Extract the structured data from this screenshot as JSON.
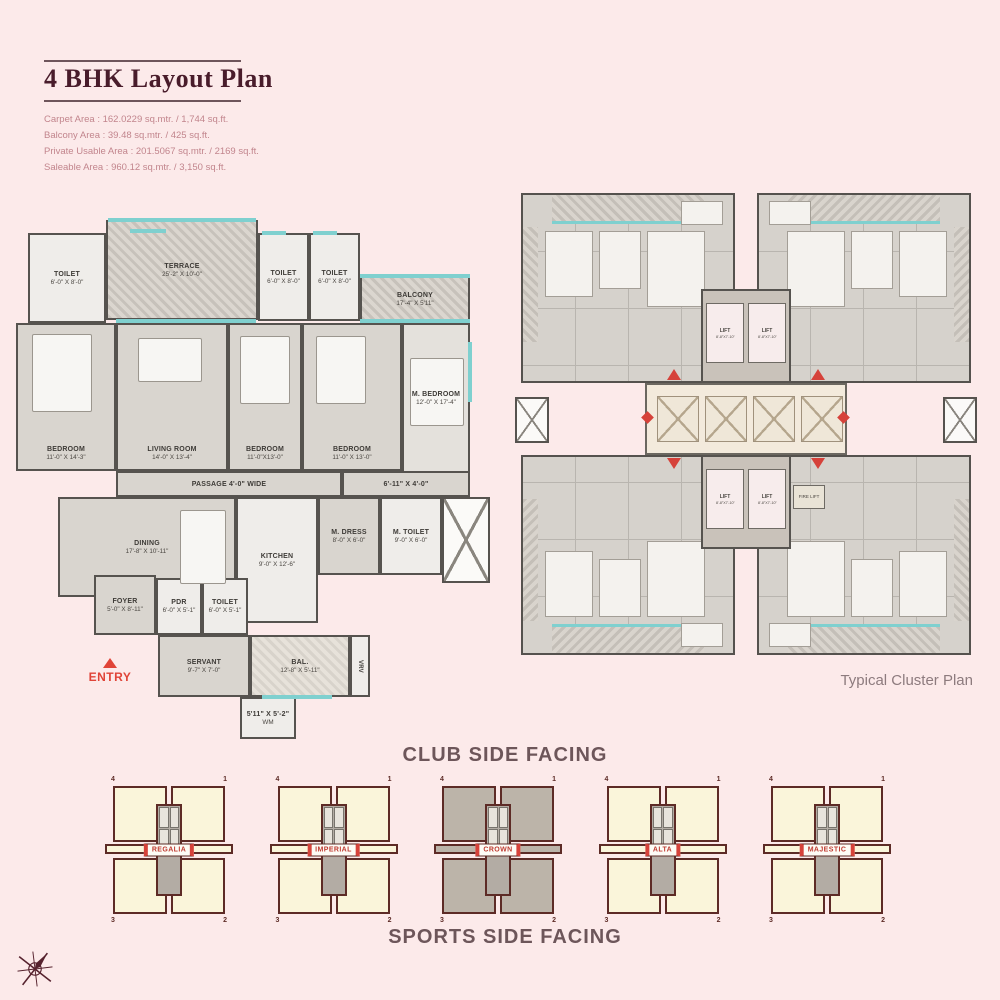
{
  "colors": {
    "background": "#fceaea",
    "accent_red": "#d6423a",
    "maroon": "#491c2b",
    "cream": "#faf5da",
    "teal": "#7fd0cf"
  },
  "header": {
    "title": "4 BHK Layout Plan",
    "area_lines": [
      "Carpet Area : 162.0229 sq.mtr. / 1,744 sq.ft.",
      "Balcony Area : 39.48 sq.mtr. / 425 sq.ft.",
      "Private Usable Area : 201.5067 sq.mtr. / 2169 sq.ft.",
      "Saleable Area : 960.12 sq.mtr. / 3,150 sq.ft."
    ]
  },
  "unit_plan": {
    "entry_label": "ENTRY",
    "rooms": [
      {
        "id": "toilet1",
        "name": "TOILET",
        "dim": "6'-0\" X 8'-0\""
      },
      {
        "id": "terrace",
        "name": "TERRACE",
        "dim": "25'-2\" X 10'-0\""
      },
      {
        "id": "toilet2",
        "name": "TOILET",
        "dim": "6'-0\" X 8'-0\""
      },
      {
        "id": "toilet3",
        "name": "TOILET",
        "dim": "6'-0\" X 8'-0\""
      },
      {
        "id": "balcony",
        "name": "BALCONY",
        "dim": "17'-4\" X 5'11\""
      },
      {
        "id": "bedroom1",
        "name": "BEDROOM",
        "dim": "11'-0\" X 14'-3\""
      },
      {
        "id": "living",
        "name": "LIVING ROOM",
        "dim": "14'-0\" X 13'-4\""
      },
      {
        "id": "bedroom2",
        "name": "BEDROOM",
        "dim": "11'-0\"X13'-0\""
      },
      {
        "id": "bedroom3",
        "name": "BEDROOM",
        "dim": "11'-0\" X 13'-0\""
      },
      {
        "id": "mbedroom",
        "name": "M. BEDROOM",
        "dim": "12'-0\" X 17'-4\""
      },
      {
        "id": "passage",
        "name": "PASSAGE 4'-0\" WIDE",
        "dim": ""
      },
      {
        "id": "passage2",
        "name": "6'-11\" X 4'-0\"",
        "dim": ""
      },
      {
        "id": "dining",
        "name": "DINING",
        "dim": "17'-8\" X 10'-11\""
      },
      {
        "id": "kitchen",
        "name": "KITCHEN",
        "dim": "9'-0\" X 12'-6\""
      },
      {
        "id": "mdress",
        "name": "M. DRESS",
        "dim": "8'-0\" X 6'-0\""
      },
      {
        "id": "mtoilet",
        "name": "M. TOILET",
        "dim": "9'-0\" X 6'-0\""
      },
      {
        "id": "foyer",
        "name": "FOYER",
        "dim": "5'-0\" X 8'-11\""
      },
      {
        "id": "pdr",
        "name": "PDR",
        "dim": "6'-0\" X 5'-1\""
      },
      {
        "id": "toilet4",
        "name": "TOILET",
        "dim": "6'-0\" X 5'-1\""
      },
      {
        "id": "servant",
        "name": "SERVANT",
        "dim": "9'-7\" X 7'-0\""
      },
      {
        "id": "bal2",
        "name": "BAL.",
        "dim": "12'-8\" X 5'-11\""
      },
      {
        "id": "wm",
        "name": "5'11\" X 5'-2\"",
        "dim": "WM"
      },
      {
        "id": "vrv",
        "name": "VRV",
        "dim": ""
      }
    ]
  },
  "cluster_plan": {
    "caption": "Typical Cluster Plan",
    "lift_label": "LIFT",
    "lift_dim": "8'-8\"X7'-10\"",
    "fire_lift_label": "FIRE LIFT"
  },
  "key_plans": {
    "club_label": "CLUB SIDE FACING",
    "sports_label": "SPORTS SIDE FACING",
    "corner_numbers": [
      "4",
      "1",
      "3",
      "2"
    ],
    "towers": [
      {
        "name": "REGALIA",
        "highlight": false
      },
      {
        "name": "IMPERIAL",
        "highlight": false
      },
      {
        "name": "CROWN",
        "highlight": true
      },
      {
        "name": "ALTA",
        "highlight": false
      },
      {
        "name": "MAJESTIC",
        "highlight": false
      }
    ]
  }
}
